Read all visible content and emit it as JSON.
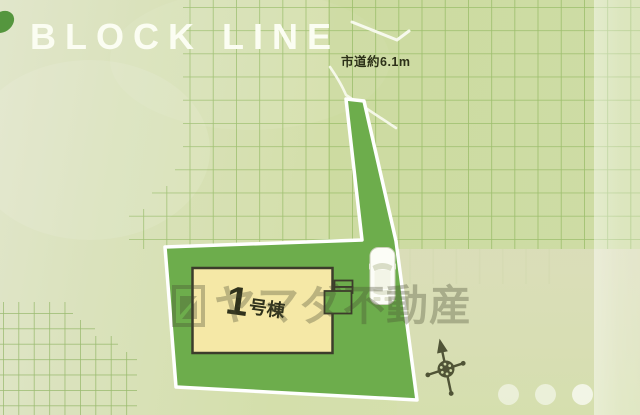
{
  "header": {
    "title": "BLOCK LINE"
  },
  "plan": {
    "road_label": "市道約6.1m",
    "building": {
      "number": "1",
      "suffix": "号棟"
    },
    "watermark_text": "ヤマダ不動産",
    "icons": {
      "compass": "compass-rose-icon",
      "car": "car-top-view-icon",
      "leaf": "leaf-blob-icon",
      "logo": "yamada-logo-icon"
    }
  },
  "carousel": {
    "dots": [
      0.5,
      0.52,
      0.68
    ]
  },
  "colors": {
    "background": "#d6e0b0",
    "plot_green": "#6dad4c",
    "plot_border": "#ffffff",
    "building_fill": "#f5e8a6",
    "building_border": "#3c3c2b",
    "grid_line": "#73a53e",
    "title_color": "#fbfdf2",
    "label_color": "#2c3018",
    "watermark_color": "#484c34"
  }
}
